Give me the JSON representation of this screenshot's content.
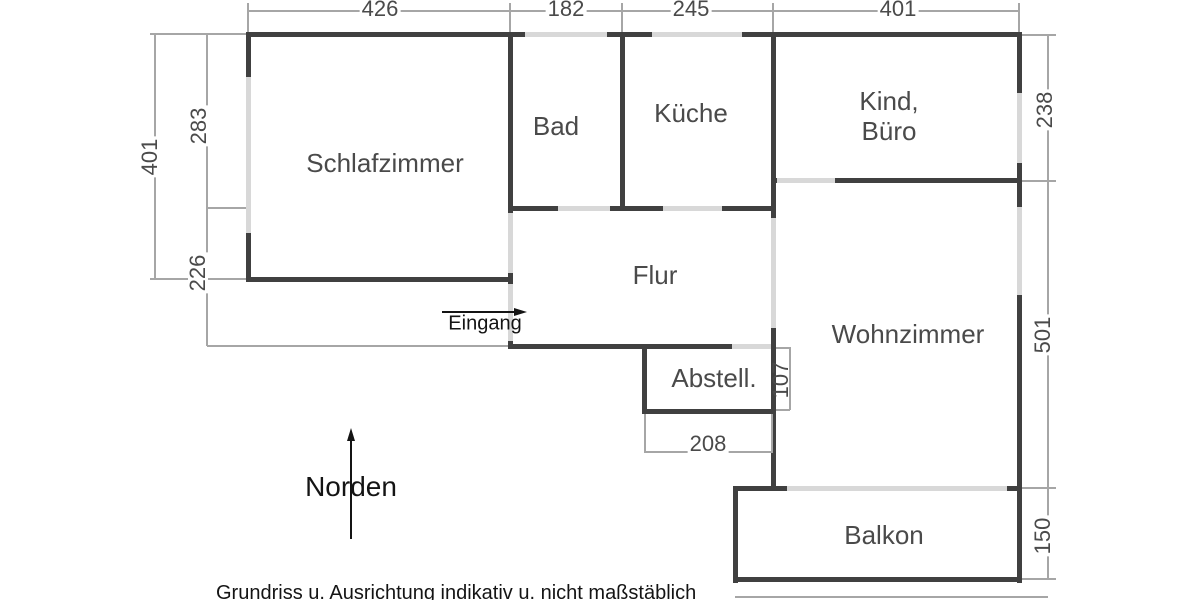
{
  "rooms": {
    "schlafzimmer": {
      "label": "Schlafzimmer"
    },
    "bad": {
      "label": "Bad"
    },
    "kueche": {
      "label": "Küche"
    },
    "kind_buero": {
      "label_line1": "Kind,",
      "label_line2": "Büro"
    },
    "flur": {
      "label": "Flur"
    },
    "wohnzimmer": {
      "label": "Wohnzimmer"
    },
    "abstell": {
      "label": "Abstell."
    },
    "balkon": {
      "label": "Balkon"
    }
  },
  "dimensions": {
    "top_schlafzimmer": "426",
    "top_bad": "182",
    "top_kueche": "245",
    "top_kind_buero": "401",
    "left_outer": "401",
    "left_upper": "283",
    "left_lower": "226",
    "right_kind_buero": "238",
    "right_wohnzimmer": "501",
    "right_balkon": "150",
    "bottom_abstell_width": "208",
    "abstell_height": "107"
  },
  "annotations": {
    "entrance_label": "Eingang",
    "north_label": "Norden",
    "disclaimer": "Grundriss u. Ausrichtung indikativ u. nicht maßstäblich"
  },
  "colors": {
    "wall": "#404040",
    "window_opening": "#d8d8d8",
    "dimension_line": "#a6a6a6",
    "room_text": "#4a4a4a",
    "annotation_text": "#141414",
    "background": "#ffffff"
  },
  "geometry": {
    "walls": [
      [
        246,
        32,
        776,
        5
      ],
      [
        246,
        32,
        5,
        250
      ],
      [
        508,
        32,
        5,
        317
      ],
      [
        620,
        32,
        5,
        179
      ],
      [
        771,
        32,
        5,
        459
      ],
      [
        1017,
        32,
        5,
        551
      ],
      [
        771,
        178,
        251,
        5
      ],
      [
        508,
        206,
        268,
        5
      ],
      [
        246,
        277,
        267,
        5
      ],
      [
        508,
        344,
        268,
        5
      ],
      [
        642,
        344,
        5,
        70
      ],
      [
        642,
        409,
        134,
        5
      ],
      [
        733,
        486,
        289,
        5
      ],
      [
        733,
        486,
        5,
        97
      ],
      [
        733,
        577,
        289,
        5
      ]
    ],
    "openings": [
      [
        525,
        32,
        82,
        5
      ],
      [
        652,
        32,
        90,
        5
      ],
      [
        246,
        77,
        5,
        156
      ],
      [
        508,
        213,
        5,
        60
      ],
      [
        508,
        284,
        5,
        57
      ],
      [
        558,
        206,
        52,
        5
      ],
      [
        663,
        206,
        59,
        5
      ],
      [
        777,
        178,
        58,
        5
      ],
      [
        771,
        218,
        5,
        110
      ],
      [
        732,
        344,
        39,
        5
      ],
      [
        1017,
        93,
        5,
        70
      ],
      [
        1017,
        207,
        5,
        88
      ],
      [
        787,
        486,
        220,
        5
      ]
    ],
    "thin_lines": [
      [
        248,
        10,
        772,
        1.5
      ],
      [
        150,
        33,
        96,
        1.5
      ],
      [
        150,
        278,
        96,
        1.5
      ],
      [
        207,
        207,
        39,
        1.5
      ],
      [
        207,
        345,
        301,
        1.5
      ],
      [
        1022,
        34,
        34,
        1.5
      ],
      [
        1022,
        180,
        34,
        1.5
      ],
      [
        1022,
        487,
        34,
        1.5
      ],
      [
        1022,
        578,
        34,
        1.5
      ],
      [
        776,
        347,
        14,
        1.5
      ],
      [
        776,
        409,
        14,
        1.5
      ],
      [
        645,
        451,
        127,
        1.5
      ],
      [
        735,
        596,
        313,
        1.5
      ],
      [
        154,
        33,
        1.5,
        246
      ],
      [
        206,
        33,
        1.5,
        313
      ],
      [
        1047,
        34,
        1.5,
        545
      ],
      [
        789,
        347,
        1.5,
        63
      ],
      [
        644,
        414,
        1.5,
        39
      ],
      [
        771,
        414,
        1.5,
        39
      ],
      [
        247,
        3,
        1.5,
        29
      ],
      [
        509,
        3,
        1.5,
        29
      ],
      [
        621,
        3,
        1.5,
        29
      ],
      [
        772,
        3,
        1.5,
        29
      ],
      [
        1018,
        3,
        1.5,
        29
      ]
    ]
  }
}
